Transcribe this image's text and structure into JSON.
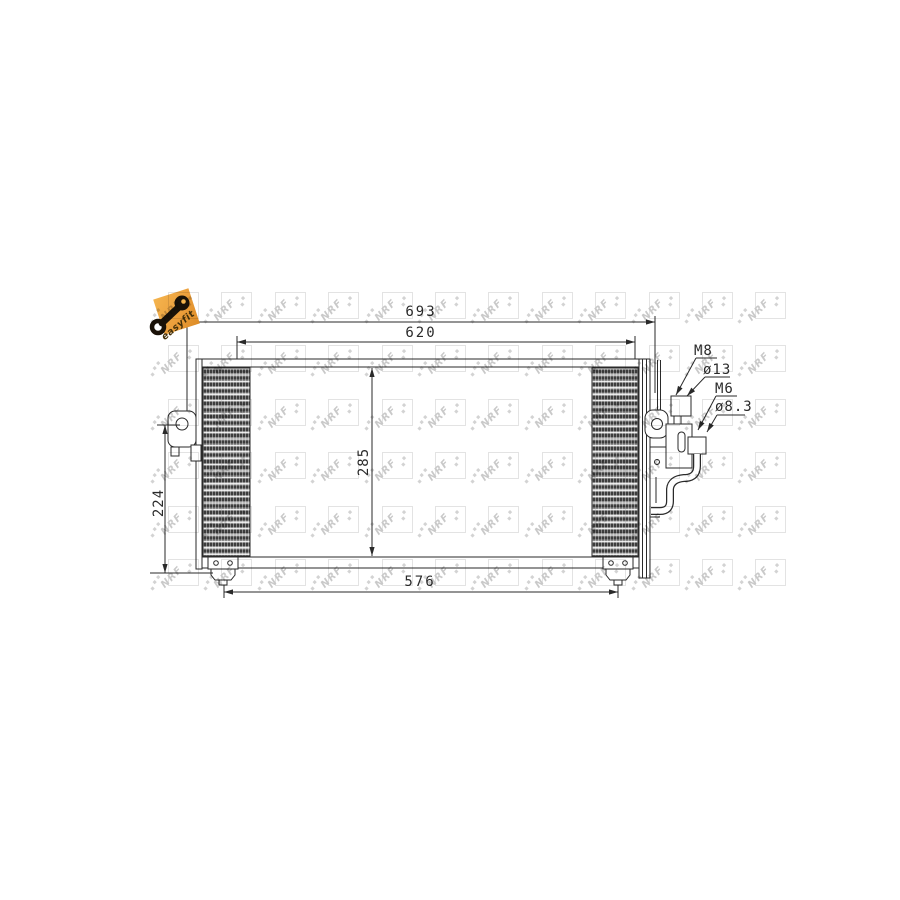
{
  "drawing": {
    "watermark": {
      "text": "NRF",
      "logo_color": "#c9c9c9",
      "square_color": "#e3e3e3"
    },
    "easyfit": {
      "label": "easyfit",
      "background": "#ec9f3c"
    },
    "line_color": "#2a2a2a",
    "dimensions": {
      "overall_width": "693",
      "upper_width": "620",
      "core_height": "285",
      "side_height": "224",
      "mount_width": "576"
    },
    "connections": {
      "upper_thread": "M8",
      "upper_diameter": "ø13",
      "lower_thread": "M6",
      "lower_diameter": "ø8.3"
    }
  }
}
